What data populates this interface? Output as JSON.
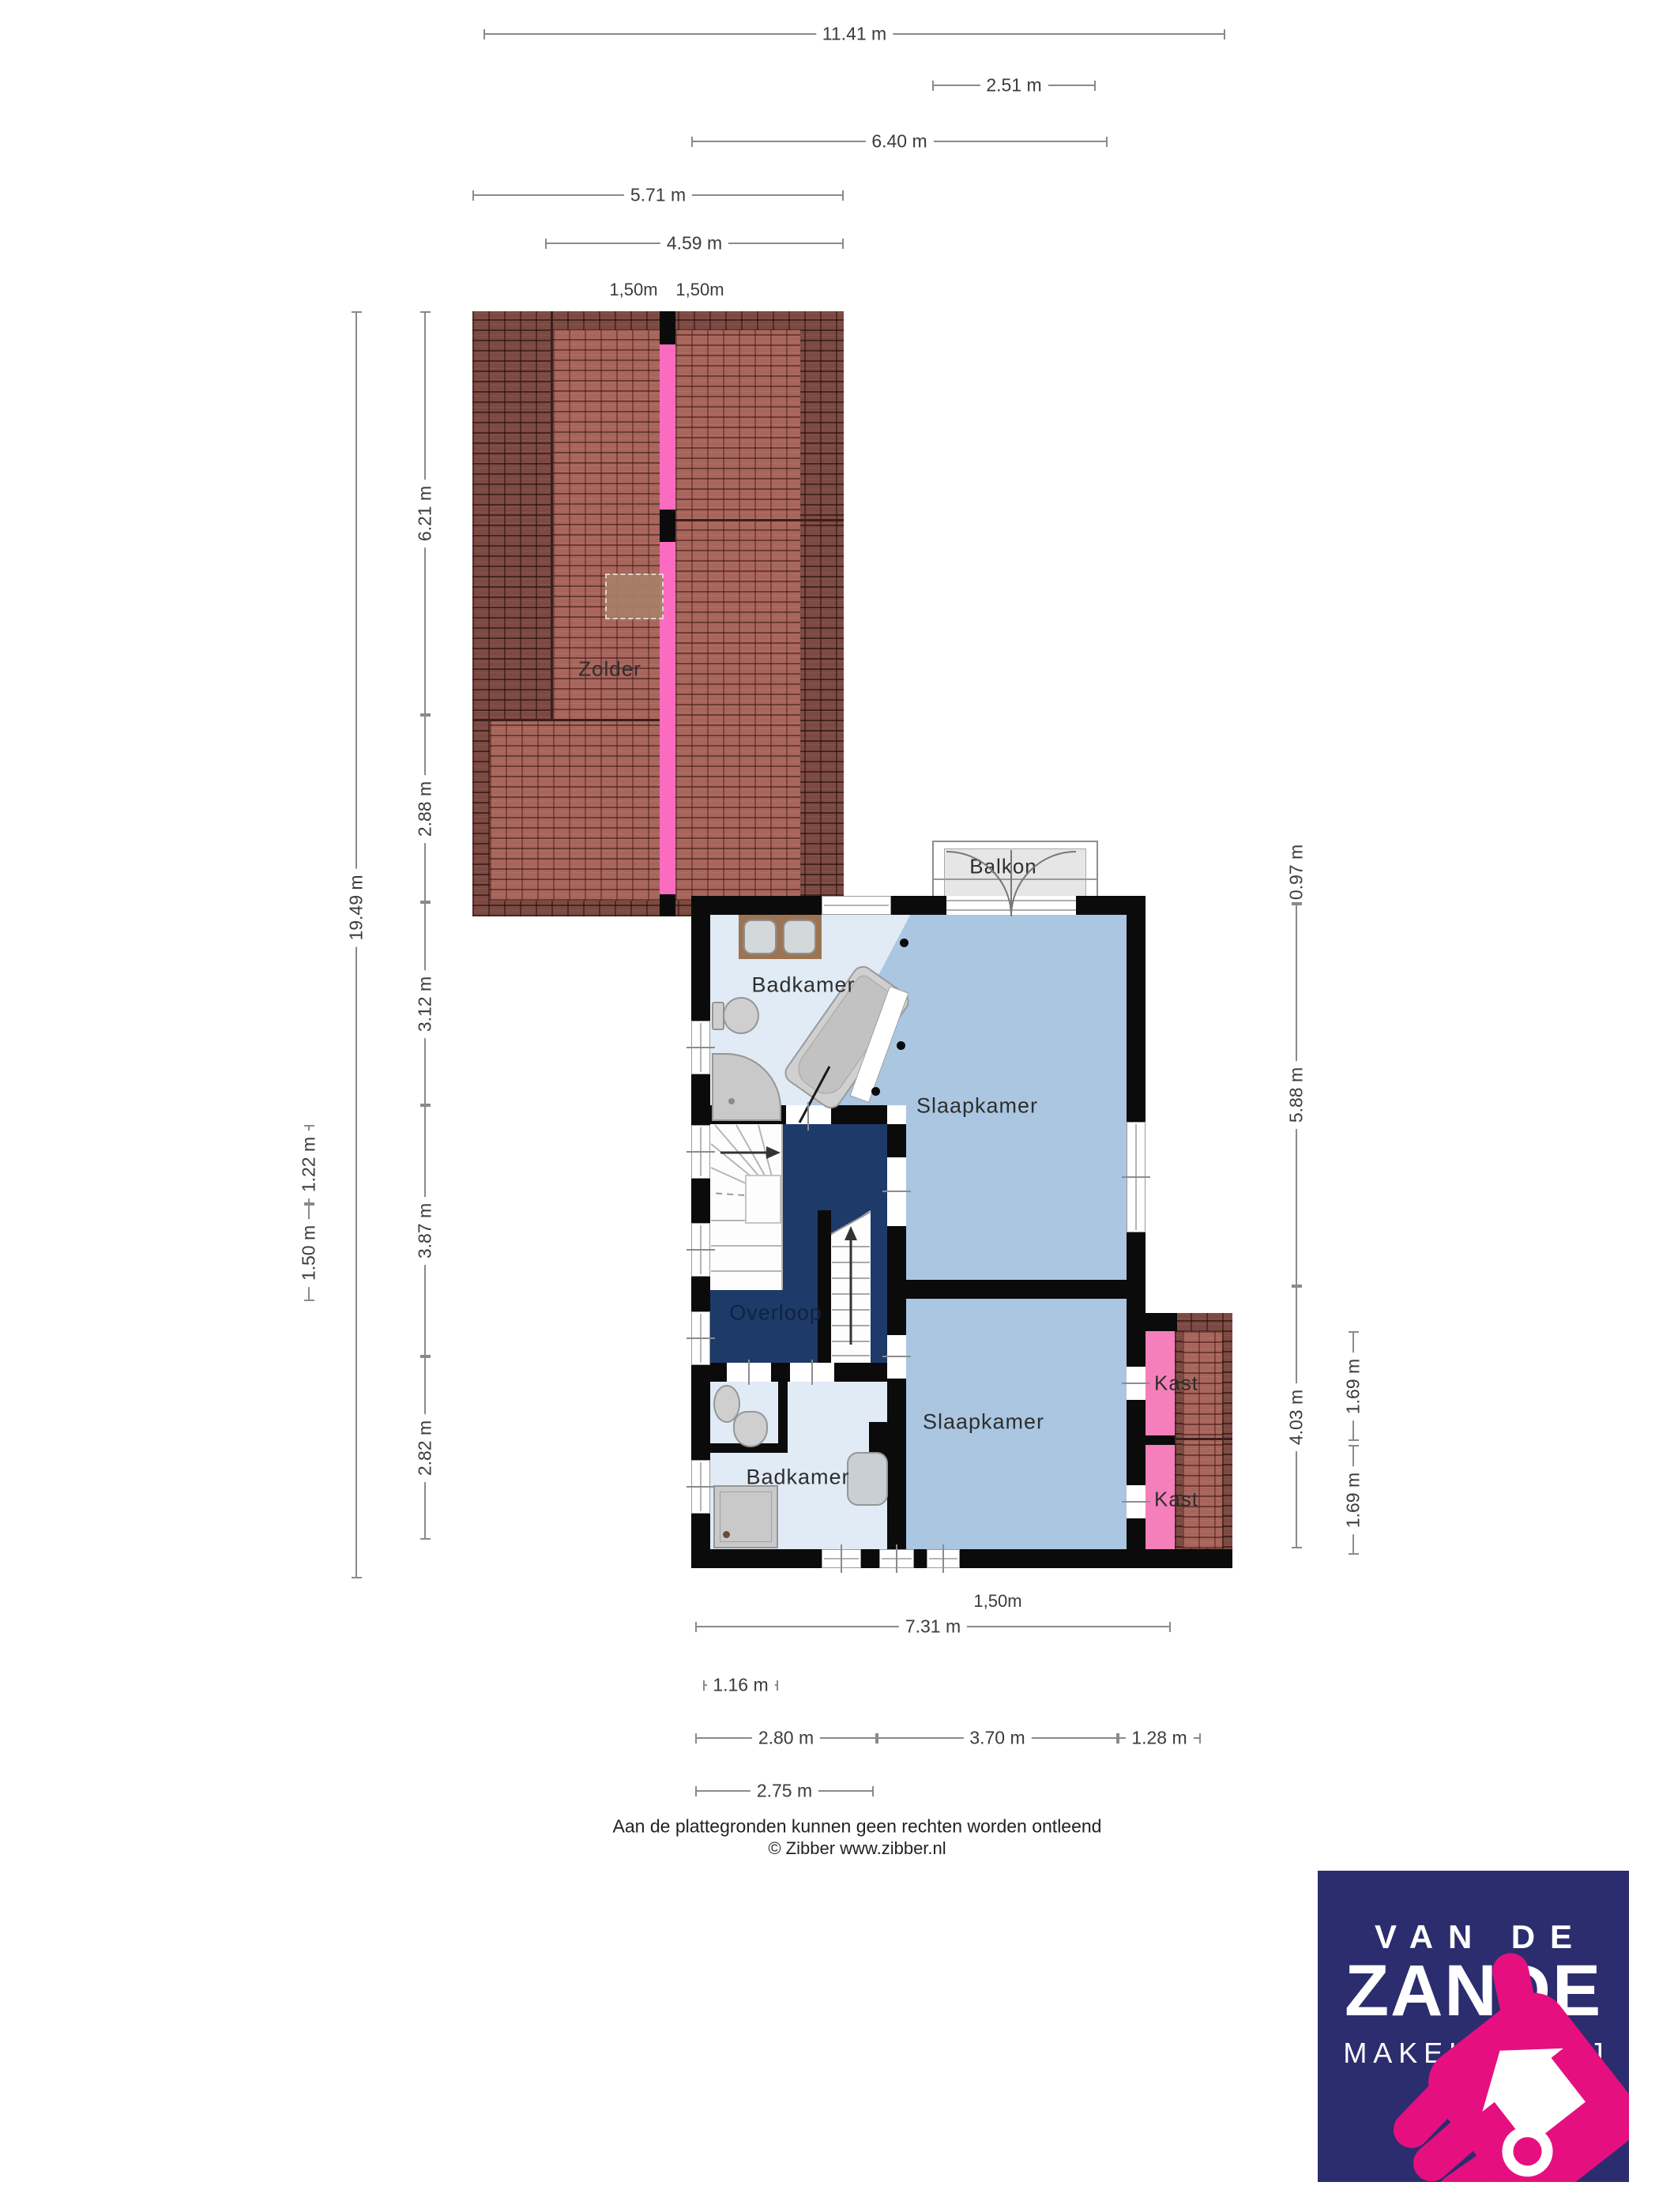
{
  "document": {
    "type": "floorplan",
    "floor": "verdieping + zolder"
  },
  "rooms": {
    "zolder": "Zolder",
    "balkon": "Balkon",
    "badkamer_boven": "Badkamer",
    "slaapkamer_1": "Slaapkamer",
    "overloop": "Overloop",
    "badkamer_onder": "Badkamer",
    "slaapkamer_2": "Slaapkamer",
    "kast_1": "Kast",
    "kast_2": "Kast"
  },
  "dimensions": {
    "top": [
      {
        "label": "11.41 m"
      },
      {
        "label": "2.51 m"
      },
      {
        "label": "6.40 m"
      },
      {
        "label": "5.71 m"
      },
      {
        "label": "4.59 m"
      }
    ],
    "ridge": [
      {
        "label": "1,50m"
      },
      {
        "label": "1,50m"
      }
    ],
    "left": [
      {
        "label": "19.49 m"
      },
      {
        "label": "6.21 m"
      },
      {
        "label": "2.88 m"
      },
      {
        "label": "3.12 m"
      },
      {
        "label": "3.87 m"
      },
      {
        "label": "2.82 m"
      },
      {
        "label": "1.22 m"
      },
      {
        "label": "1.50 m"
      }
    ],
    "right": [
      {
        "label": "0.97 m"
      },
      {
        "label": "5.88 m"
      },
      {
        "label": "4.03 m"
      },
      {
        "label": "1.69 m"
      },
      {
        "label": "1.69 m"
      }
    ],
    "bottom": [
      {
        "label": "1,50m"
      },
      {
        "label": "7.31 m"
      },
      {
        "label": "1.16 m"
      },
      {
        "label": "2.80 m"
      },
      {
        "label": "3.70 m"
      },
      {
        "label": "1.28 m"
      },
      {
        "label": "2.75 m"
      }
    ]
  },
  "footer": {
    "disclaimer": "Aan de plattegronden kunnen geen rechten worden ontleend",
    "credit": "© Zibber www.zibber.nl"
  },
  "logo": {
    "line1": "VAN DE",
    "line2": "ZANDE",
    "line3": "MAKELAARDIJ"
  },
  "colors": {
    "bedroom_blue": "#aac6e1",
    "bathroom_light": "#e0ebf5",
    "landing_navy": "#1d3a69",
    "closet_pink": "#f57fba",
    "roof_stripe_pink": "#fb6cc0",
    "roof_tile_dark": "#7c4a42",
    "roof_tile_light": "#a8655c",
    "wall_black": "#0b0b0b",
    "balcony_gray": "#e6e6e6",
    "logo_navy": "#2b2d6e",
    "logo_pink": "#e60f7f"
  }
}
